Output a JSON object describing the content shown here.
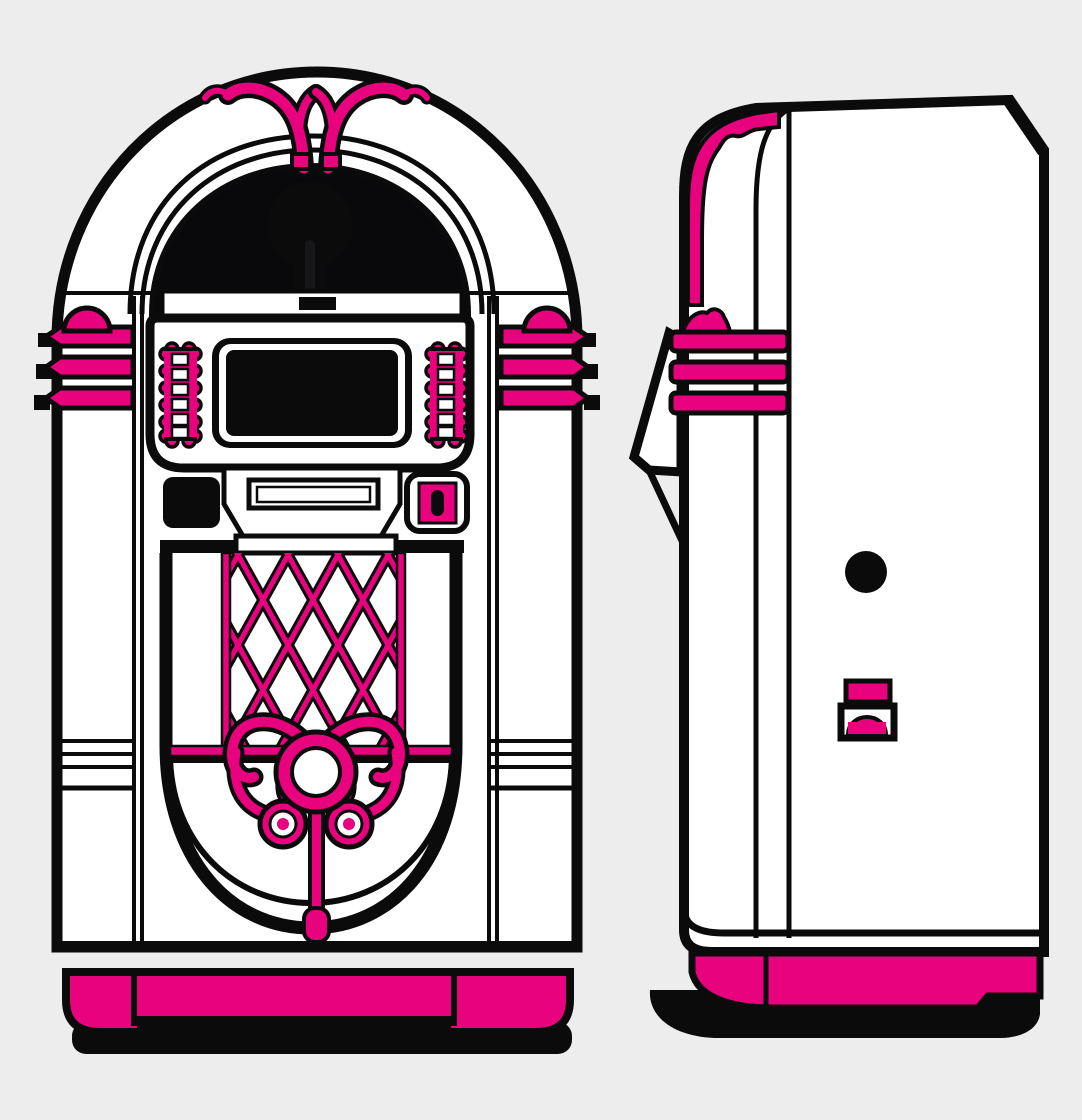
{
  "illustration": {
    "alt": "Retro jukebox illustration in pink, white and black; front view on the left and side view on the right"
  },
  "colors": {
    "bg": "#ECEDEC",
    "ink": "#0B0B0C",
    "paper": "#FFFFFF",
    "pink": "#E8027E",
    "dome": "#09090B",
    "shadow": "#0A0A0A",
    "keyhole": "#17171A"
  }
}
